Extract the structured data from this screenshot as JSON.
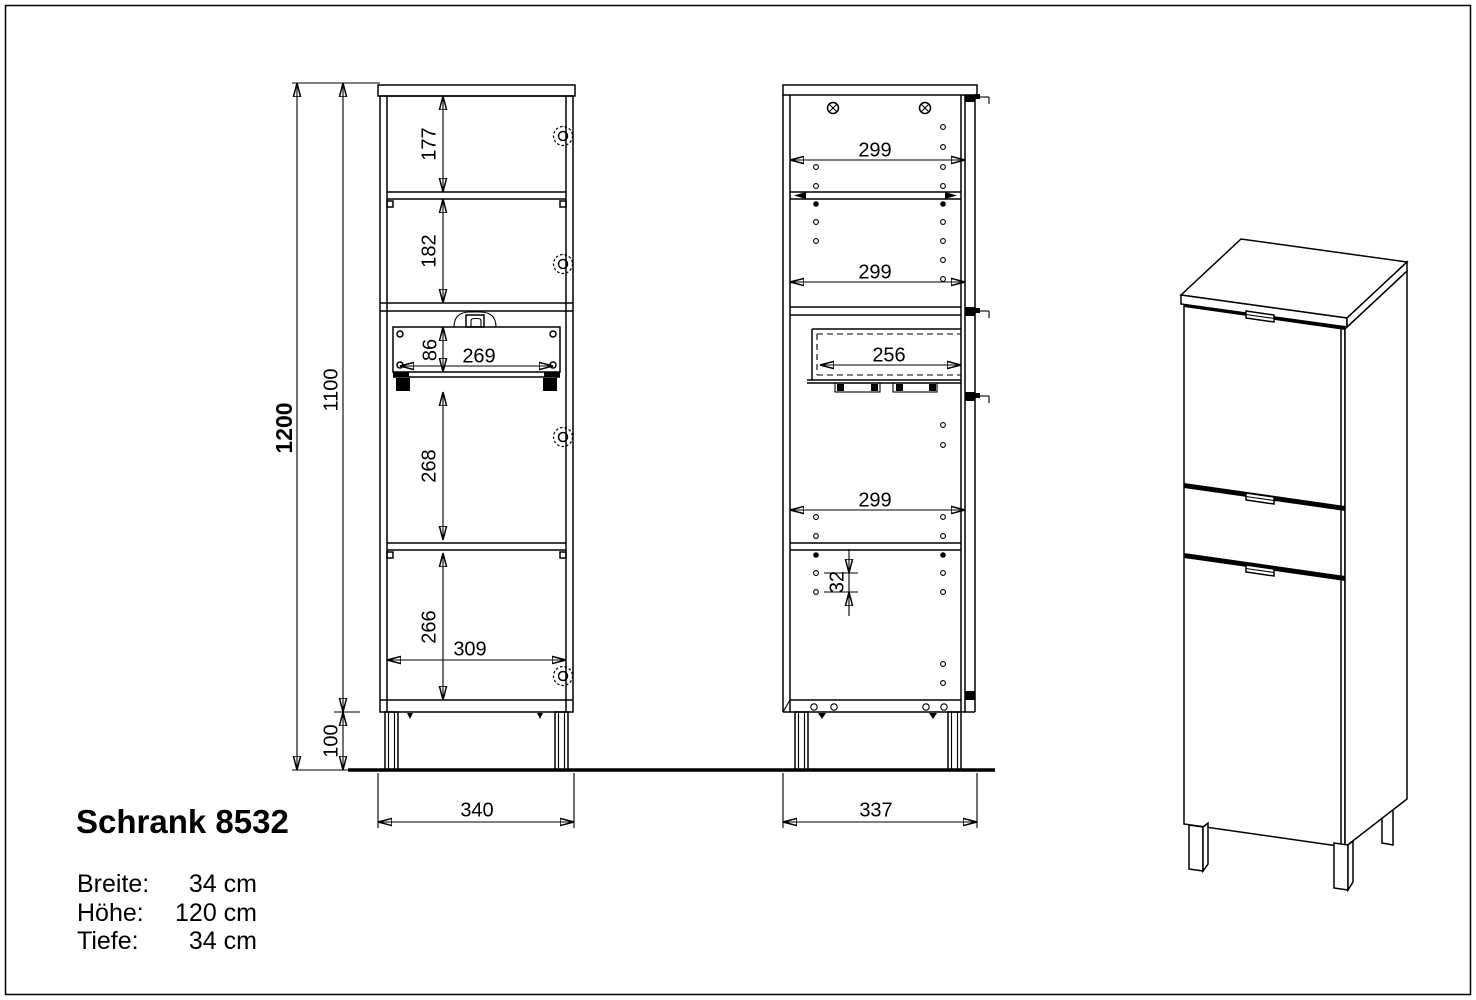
{
  "title": "Schrank 8532",
  "specs": {
    "rows": [
      {
        "label": "Breite:",
        "value": "34 cm"
      },
      {
        "label": "Höhe:",
        "value": "120 cm"
      },
      {
        "label": "Tiefe:",
        "value": "34 cm"
      }
    ]
  },
  "front_view": {
    "total_height": "1200",
    "carcass_height": "1100",
    "foot_height": "100",
    "top_compartment": "177",
    "second_compartment": "182",
    "drawer_front_height": "86",
    "drawer_width": "269",
    "third_compartment": "268",
    "bottom_compartment": "266",
    "inner_width": "309",
    "overall_width": "340"
  },
  "side_view": {
    "top_depth": "299",
    "mid_depth": "299",
    "drawer_depth": "256",
    "lower_depth": "299",
    "hole_pitch": "32",
    "overall_depth": "337"
  },
  "colors": {
    "ink": "#000000",
    "paper": "#ffffff"
  }
}
